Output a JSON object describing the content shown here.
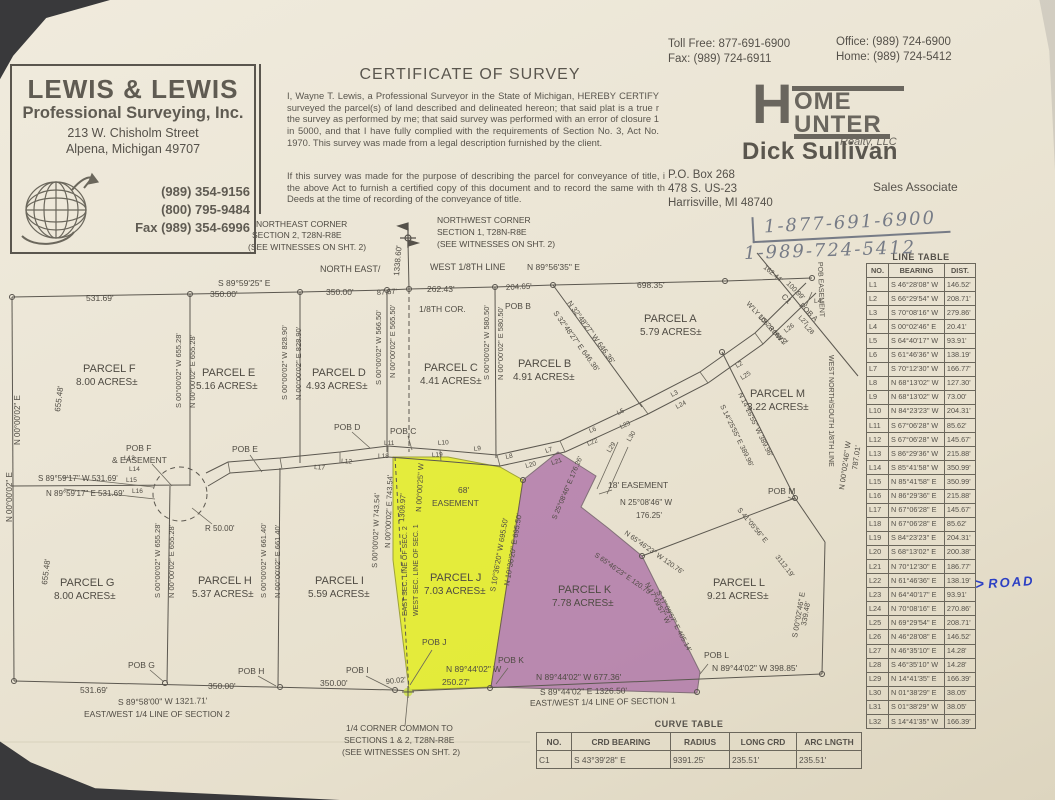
{
  "header": {
    "surveyor": {
      "name": "LEWIS & LEWIS",
      "tagline": "Professional Surveying, Inc.",
      "addr1": "213 W. Chisholm Street",
      "addr2": "Alpena, Michigan 49707",
      "phone1": "(989) 354-9156",
      "phone2": "(800) 795-9484",
      "fax": "Fax (989) 354-6996"
    },
    "certificate": {
      "title": "CERTIFICATE OF SURVEY",
      "para1": "I, Wayne T. Lewis, a Professional Surveyor in the State of Michigan, HEREBY CERTIFY surveyed the parcel(s) of land described and delineated hereon; that said plat is a true r the survey as performed by me; that said survey was performed with an error of closure 1 in 5000, and that I have fully complied with the requirements of Section No. 3, Act No. 1970.  This survey was made from a legal description furnished by the client.",
      "para2": "If this survey was made for the purpose of describing the parcel for conveyance of title, i the above Act to furnish a certified copy of this document and to record the same with th Deeds at the time of recording of the conveyance of title."
    },
    "realtor": {
      "toll_free": "Toll Free: 877-691-6900",
      "fax": "Fax: (989) 724-6911",
      "office": "Office: (989) 724-6900",
      "home": "Home: (989) 724-5412",
      "logo_h": "H",
      "logo_line1": "OME",
      "logo_line2": "UNTER",
      "logo_sub": "Realty, LLC",
      "agent": "Dick Sullivan",
      "addr1": "P.O. Box 268",
      "addr2": "478 S. US-23",
      "addr3": "Harrisville, MI 48740",
      "role": "Sales Associate",
      "handwritten1": "1-877-691-6900",
      "handwritten2": "1-989-724-5412"
    }
  },
  "annotations": {
    "road_arrow": ">",
    "road": "ROAD"
  },
  "colors": {
    "highlight_yellow": "#e3ef12",
    "highlight_purple": "#a868a4",
    "ink": "#55514a",
    "pen_blue": "#2b3fc4"
  },
  "line_table": {
    "title": "LINE TABLE",
    "headers": [
      "NO.",
      "BEARING",
      "DIST."
    ],
    "rows": [
      {
        "no": "L1",
        "bearing": "S 46°28'08\" W",
        "dist": "146.52'"
      },
      {
        "no": "L2",
        "bearing": "S 66°29'54\" W",
        "dist": "208.71'"
      },
      {
        "no": "L3",
        "bearing": "S 70°08'16\" W",
        "dist": "279.86'"
      },
      {
        "no": "L4",
        "bearing": "S 00°02'46\" E",
        "dist": "20.41'"
      },
      {
        "no": "L5",
        "bearing": "S 64°40'17\" W",
        "dist": "93.91'"
      },
      {
        "no": "L6",
        "bearing": "S 61°46'36\" W",
        "dist": "138.19'"
      },
      {
        "no": "L7",
        "bearing": "S 70°12'30\" W",
        "dist": "166.77'"
      },
      {
        "no": "L8",
        "bearing": "N 68°13'02\" W",
        "dist": "127.30'"
      },
      {
        "no": "L9",
        "bearing": "N 68°13'02\" W",
        "dist": "73.00'"
      },
      {
        "no": "L10",
        "bearing": "N 84°23'23\" W",
        "dist": "204.31'"
      },
      {
        "no": "L11",
        "bearing": "S 67°06'28\" W",
        "dist": "85.62'"
      },
      {
        "no": "L12",
        "bearing": "S 67°06'28\" W",
        "dist": "145.67'"
      },
      {
        "no": "L13",
        "bearing": "S 86°29'36\" W",
        "dist": "215.88'"
      },
      {
        "no": "L14",
        "bearing": "S 85°41'58\" W",
        "dist": "350.99'"
      },
      {
        "no": "L15",
        "bearing": "N 85°41'58\" E",
        "dist": "350.99'"
      },
      {
        "no": "L16",
        "bearing": "N 86°29'36\" E",
        "dist": "215.88'"
      },
      {
        "no": "L17",
        "bearing": "N 67°06'28\" E",
        "dist": "145.67'"
      },
      {
        "no": "L18",
        "bearing": "N 67°06'28\" E",
        "dist": "85.62'"
      },
      {
        "no": "L19",
        "bearing": "S 84°23'23\" E",
        "dist": "204.31'"
      },
      {
        "no": "L20",
        "bearing": "S 68°13'02\" E",
        "dist": "200.38'"
      },
      {
        "no": "L21",
        "bearing": "N 70°12'30\" E",
        "dist": "186.77'"
      },
      {
        "no": "L22",
        "bearing": "N 61°46'36\" E",
        "dist": "138.19'"
      },
      {
        "no": "L23",
        "bearing": "N 64°40'17\" E",
        "dist": "93.91'"
      },
      {
        "no": "L24",
        "bearing": "N 70°08'16\" E",
        "dist": "270.86'"
      },
      {
        "no": "L25",
        "bearing": "N 69°29'54\" E",
        "dist": "208.71'"
      },
      {
        "no": "L26",
        "bearing": "N 46°28'08\" E",
        "dist": "146.52'"
      },
      {
        "no": "L27",
        "bearing": "N 46°35'10\" E",
        "dist": "14.28'"
      },
      {
        "no": "L28",
        "bearing": "S 46°35'10\" W",
        "dist": "14.28'"
      },
      {
        "no": "L29",
        "bearing": "N 14°41'35\" E",
        "dist": "166.39'"
      },
      {
        "no": "L30",
        "bearing": "N 01°38'29\" E",
        "dist": "38.05'"
      },
      {
        "no": "L31",
        "bearing": "S 01°38'29\" W",
        "dist": "38.05'"
      },
      {
        "no": "L32",
        "bearing": "S 14°41'35\" W",
        "dist": "166.39'"
      }
    ]
  },
  "curve_table": {
    "title": "CURVE TABLE",
    "headers": [
      "NO.",
      "CRD BEARING",
      "RADIUS",
      "LONG CRD",
      "ARC LNGTH"
    ],
    "rows": [
      {
        "no": "C1",
        "bearing": "S 43°39'28\" E",
        "radius": "9391.25'",
        "long_crd": "235.51'",
        "arc": "235.51'"
      }
    ]
  },
  "map": {
    "labels": {
      "ne1": "NORTHEAST CORNER",
      "ne2": "SECTION 2, T28N-R8E",
      "ne3": "(SEE WITNESSES ON SHT. 2)",
      "nw1": "NORTHWEST CORNER",
      "nw2": "SECTION 1, T28N-R8E",
      "nw3": "(SEE WITNESSES ON SHT. 2)",
      "northline1": "NORTH EAST/",
      "northline2": "WEST 1/8TH LINE",
      "dim1338": "1338.60'",
      "brg8959": "S 89°59'25\" E",
      "brg8956": "N 89°56'35\" E",
      "d531a": "531.69'",
      "d350a": "350.00'",
      "d350b": "350.00'",
      "d8757": "87.57'",
      "d26243": "262.43'",
      "d20465": "204.65'",
      "d69835": "698.35'",
      "cor18": "1/8TH COR.",
      "pobB": "POB B",
      "pf1": "PARCEL F",
      "pf2": "8.00 ACRES±",
      "pe1": "PARCEL E",
      "pe2": "5.16 ACRES±",
      "pd1": "PARCEL D",
      "pd2": "4.93 ACRES±",
      "pc1": "PARCEL C",
      "pc2": "4.41 ACRES±",
      "pb1": "PARCEL B",
      "pb2": "4.91 ACRES±",
      "pa1": "PARCEL A",
      "pa2": "5.79 ACRES±",
      "pm1": "PARCEL M",
      "pm2": "3.22 ACRES±",
      "pg1": "PARCEL G",
      "pg2": "8.00 ACRES±",
      "ph1": "PARCEL H",
      "ph2": "5.37 ACRES±",
      "pi1": "PARCEL I",
      "pi2": "5.59 ACRES±",
      "pj1": "PARCEL J",
      "pj2": "7.03 ACRES±",
      "pk1": "PARCEL K",
      "pk2": "7.78 ACRES±",
      "pl1": "PARCEL L",
      "pl2": "9.21 ACRES±",
      "vF": "655.48'",
      "vNE1": "N 00°00'02\" E",
      "vFEw": "S 00°00'02\" W  655.28'",
      "vFEe": "N 00°00'02\" E  655.28'",
      "vEDw": "S 00°00'02\" W  828.90'",
      "vEDe": "N 00°00'02\" E  828.90'",
      "vDCw": "S 00°00'02\" W  566.50'",
      "vDCe": "N 00°00'02\" E  565.50'",
      "vCBw": "S 00°00'02\" W  580.50'",
      "vCBe": "N 00°00'02\" E  580.50'",
      "diagBw": "N 32°48'27\" W  646.36'",
      "diagBe": "S 32°48'27\" E  646.36'",
      "pobF1": "POB F",
      "pobF2": "& EASEMENT",
      "brg8959w": "S 89°59'17\" W  531.69'",
      "brg8959e": "N 89°59'17\" E  531.69'",
      "vG": "655.48'",
      "vNE2": "N 00°00'02\" E",
      "vGHw": "S 00°00'02\" W  655.28'",
      "vGHe": "N 00°00'02\" E  655.28'",
      "vHIw": "S 00°00'02\" W  661.40'",
      "vHIe": "N 00°00'02\" E  661.40'",
      "vIw": "S 00°00'02\" W  743.54'",
      "vIe": "N 00°00'02\" E  743.54'",
      "v1309": "1309.97'",
      "vN00025": "N 00°00'25\" W",
      "vEsec": "EAST SEC. LINE OF SEC. 2",
      "vWsec": "WEST SEC. LINE OF SEC. 1",
      "r50": "R 50.00'",
      "pobE": "POB E",
      "pobD": "POB D",
      "pobC": "POB C",
      "pobG": "POB G",
      "pobH": "POB H",
      "pobI": "POB I",
      "pobJ": "POB J",
      "pobK": "POB K",
      "pobL": "POB L",
      "pobM": "POB M",
      "pobA": "POB A",
      "e68a": "68'",
      "e68b": "EASEMENT",
      "e18": "18' EASEMENT",
      "n2508a": "N 25°08'46\" W",
      "n2508b": "176.25'",
      "s2508": "S 25°08'46\" E 176.26'",
      "n6546": "N 65°46'23\" W 120.76'",
      "s6546": "S 65°46'23\" E 120.75'",
      "n1709": "N 17°09'57\" W",
      "s1709": "S 17°09'57\" E 405.14'",
      "jW": "S 10°36'20\" W  695.50'",
      "jE": "N 10°36'20\" E  695.50'",
      "kbot": "N 89°44'02\" W  677.36'",
      "jbot1": "N 89°44'02\" W",
      "jbot2": "250.27'",
      "lbot": "N 89°44'02\" W  398.85'",
      "d90": "90.02'",
      "d531b": "531.69'",
      "d350c": "350.00'",
      "d350d": "350.00'",
      "qsec2a": "S 89°58'00\" W  1321.71'",
      "qsec2b": "EAST/WEST 1/4 LINE OF SECTION 2",
      "qsec1a": "S 89°44'02\" E  1326.50'",
      "qsec1b": "EAST/WEST 1/4 LINE OF SECTION 1",
      "qcor1": "1/4 CORNER COMMON TO",
      "qcor2": "SECTIONS 1 & 2, T28N-R8E",
      "qcor3": "(SEE WITNESSES ON SHT. 2)",
      "n1426": "N 14°26'55\" W 389.96'",
      "s1425": "S 14°25'55\" E 389.96'",
      "s4105": "S 41°05'56\" E",
      "d3112": "3112.19'",
      "vLe1": "S 00°02'46\" E",
      "vLe2": "339.48'",
      "d787": "787.01'",
      "vN00246": "N 00°02'46\" W",
      "wns18": "WEST NORTH/SOUTH 1/8TH LINE",
      "pobEas": "POB EASEMENT",
      "d16244": "162.44'",
      "d10099": "100.99'",
      "c1lbl": "C1",
      "wly1": "W'LY 106' ROW",
      "wly2": "US 23 HWY",
      "l1": "L1",
      "l2": "L2",
      "l3": "L3",
      "l4": "L4",
      "l5": "L5",
      "l6": "L6",
      "l7": "L7",
      "l8": "L8",
      "l9": "L9",
      "l10": "L10",
      "l11": "L11",
      "l12": "L12",
      "l13": "L13",
      "l14": "L14",
      "l15": "L15",
      "l16": "L16",
      "l17": "L17",
      "l18": "L18",
      "l19": "L19",
      "l20": "L20",
      "l21": "L21",
      "l22": "L22",
      "l23": "L23",
      "l24": "L24",
      "l25": "L25",
      "l26": "L26",
      "l27": "L27",
      "l28": "L28",
      "l29": "L29",
      "l30": "L30"
    }
  }
}
